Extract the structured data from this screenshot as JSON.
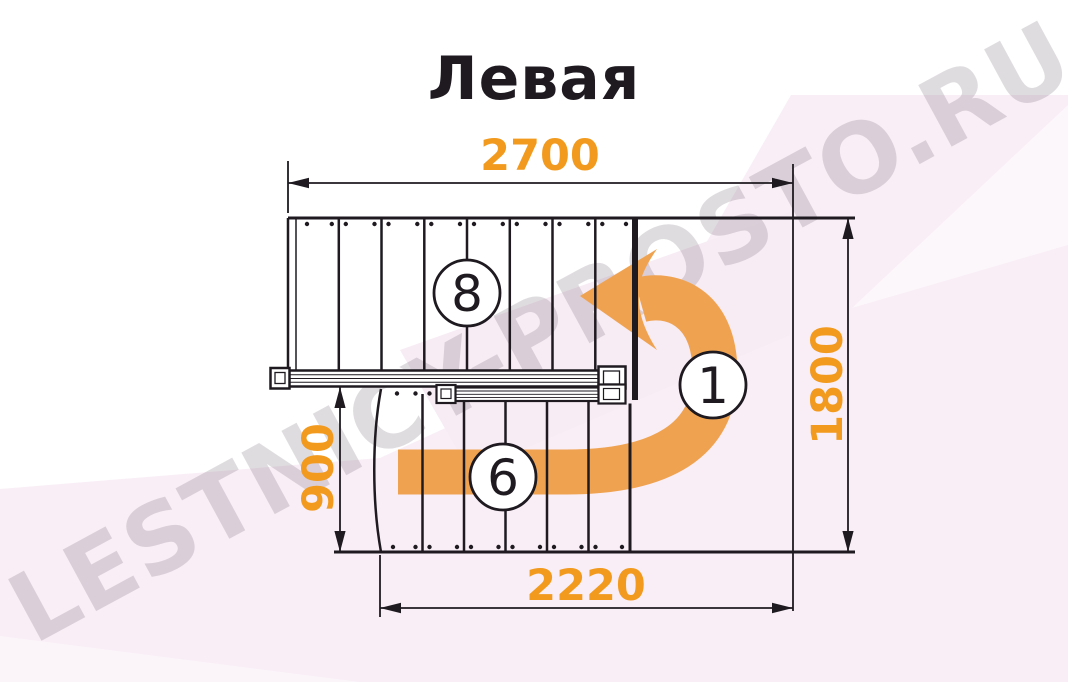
{
  "title": "Левая",
  "watermark": "LESTNICY-PROSTO.RU",
  "dimensions": {
    "top": "2700",
    "right": "1800",
    "left": "900",
    "bottom": "2220"
  },
  "markers": {
    "upper_flight_steps": "8",
    "turn_number": "1",
    "lower_flight_steps": "6"
  },
  "colors": {
    "dimension_text": "#F29A1D",
    "arrow_orange": "#EFA351",
    "drawing_line": "#1E1A20",
    "background_pink": "#F9EEF6",
    "watermark_gray": "#DCD8DC"
  }
}
